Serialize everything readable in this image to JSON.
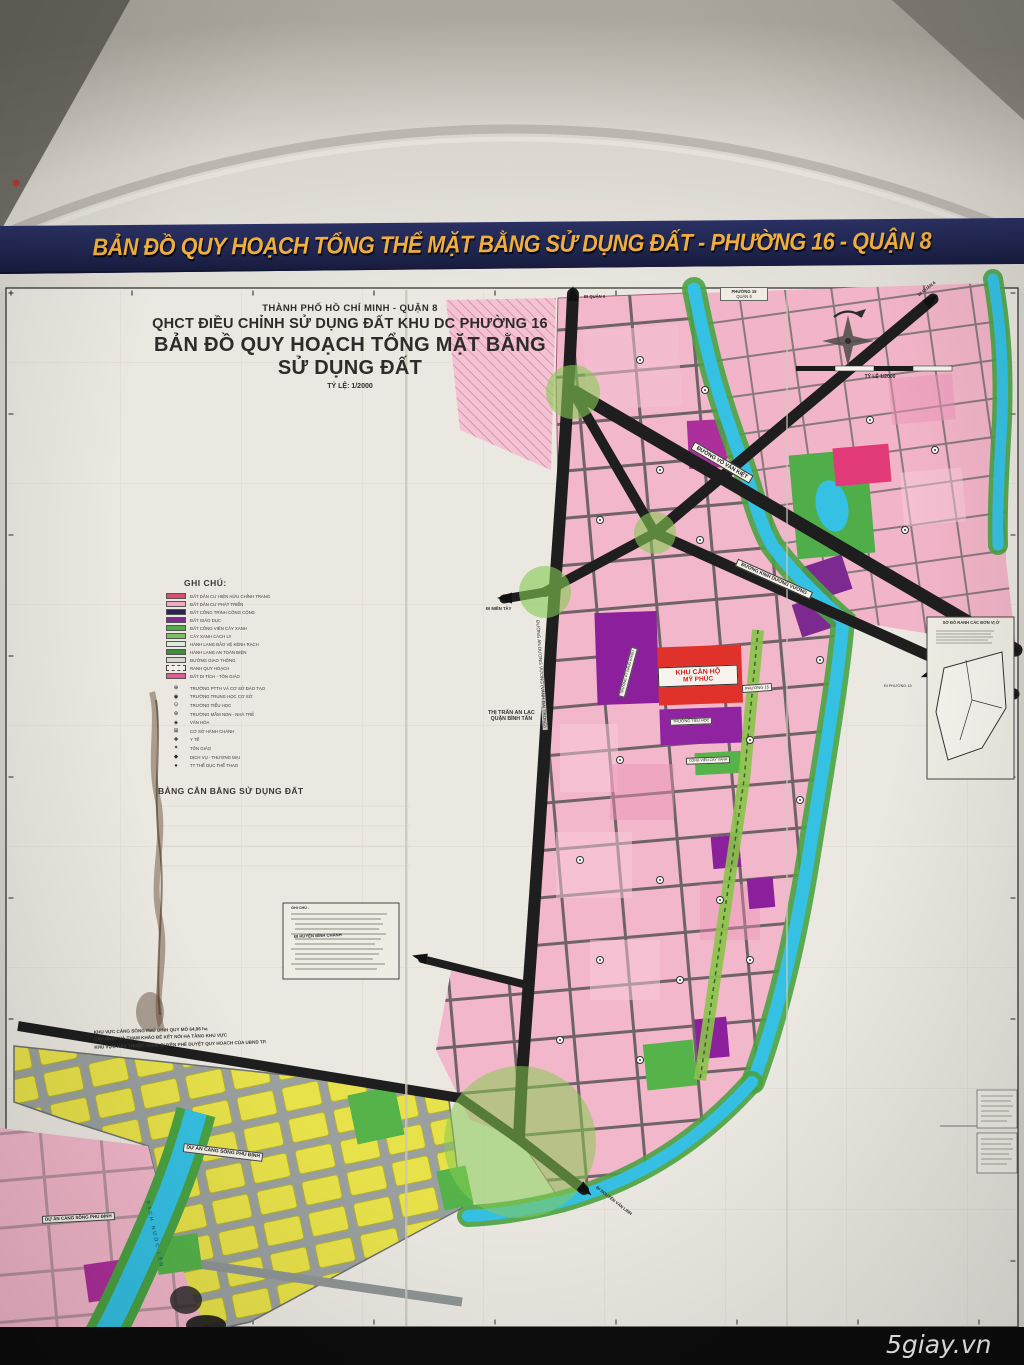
{
  "banner": {
    "title": "BẢN ĐỒ QUY HOẠCH TỔNG THỂ MẶT BẰNG SỬ DỤNG ĐẤT - PHƯỜNG 16 - QUẬN 8"
  },
  "header": {
    "line1": "THÀNH PHỐ HỒ CHÍ MINH - QUẬN 8",
    "line2": "QHCT ĐIỀU CHỈNH SỬ DỤNG ĐẤT KHU DC PHƯỜNG 16",
    "line3": "BẢN ĐỒ QUY HOẠCH TỔNG MẶT BẰNG SỬ DỤNG ĐẤT",
    "line4": "TỶ LỆ: 1/2000"
  },
  "compass": {
    "scale_caption": "TỶ LỆ 1/2000"
  },
  "legend": {
    "title": "GHI CHÚ:",
    "items": [
      {
        "label": "ĐẤT DÂN CƯ HIỆN HỮU CHỈNH TRANG",
        "color": "#d94f72"
      },
      {
        "label": "ĐẤT DÂN CƯ PHÁT TRIỂN",
        "color": "#f2a8c0"
      },
      {
        "label": "ĐẤT CÔNG TRÌNH CÔNG CỘNG",
        "color": "#2a2550"
      },
      {
        "label": "ĐẤT GIÁO DỤC",
        "color": "#7b2a8f"
      },
      {
        "label": "ĐẤT CÔNG VIÊN CÂY XANH",
        "color": "#4fae4a"
      },
      {
        "label": "CÂY XANH CÁCH LY",
        "color": "#7dbf63"
      },
      {
        "label": "HÀNH LANG BẢO VỆ KÊNH RẠCH",
        "color": "#dcead8"
      },
      {
        "label": "HÀNH LANG AN TOÀN ĐIỆN",
        "color": "#3f8f3f"
      },
      {
        "label": "ĐƯỜNG GIAO THÔNG",
        "color": "#d9d6cf"
      },
      {
        "label": "RANH QUY HOẠCH",
        "color": "#f1eee6"
      },
      {
        "label": "ĐẤT DI TÍCH - TÔN GIÁO",
        "color": "#e05a94"
      }
    ],
    "symbols": [
      {
        "glyph": "⊕",
        "label": "TRƯỜNG PTTH VÀ CƠ SỞ ĐÀO TẠO"
      },
      {
        "glyph": "◉",
        "label": "TRƯỜNG TRUNG HỌC CƠ SỞ"
      },
      {
        "glyph": "⊙",
        "label": "TRƯỜNG TIỂU HỌC"
      },
      {
        "glyph": "⊛",
        "label": "TRƯỜNG MẦM NON - NHÀ TRẺ"
      },
      {
        "glyph": "◈",
        "label": "VĂN HÓA"
      },
      {
        "glyph": "⊞",
        "label": "CƠ SỞ HÀNH CHÁNH"
      },
      {
        "glyph": "✚",
        "label": "Y TẾ"
      },
      {
        "glyph": "✦",
        "label": "TÔN GIÁO"
      },
      {
        "glyph": "◆",
        "label": "DỊCH VỤ - THƯƠNG MẠI"
      },
      {
        "glyph": "●",
        "label": "TT THỂ DỤC THỂ THAO"
      }
    ]
  },
  "balance": {
    "title": "BẢNG CÂN BẰNG SỬ DỤNG ĐẤT"
  },
  "note_box": {
    "title": "GHI CHÚ :"
  },
  "minimap": {
    "title": "SƠ ĐỒ RANH CÁC ĐƠN VỊ Ở",
    "exit_label": "ĐI PHƯỜNG 15"
  },
  "map_labels": {
    "phuong15": "PHƯỜNG 15",
    "quan6": "QUẬN 6",
    "thi_tran_1": "THỊ TRẤN AN LẠC",
    "thi_tran_2": "QUẬN BÌNH TÂN",
    "road_v": "ĐƯỜNG AN DƯƠNG VƯƠNG (VÀNH ĐAI TRONG)",
    "road_a": "ĐƯỜNG VÕ VĂN KIỆT",
    "road_b": "ĐƯỜNG KINH DƯƠNG VƯƠNG",
    "di_mien_tay": "ĐI MIỀN TÂY",
    "di_quan6": "ĐI QUẬN 6",
    "di_quan6_2": "ĐI QUẬN 6",
    "di_binh_chanh": "ĐI HUYỆN BÌNH CHÁNH",
    "di_nvl": "ĐI NGUYỄN VĂN LINH",
    "khu_can_ho_1": "KHU CĂN HỘ",
    "khu_can_ho_2": "MỸ PHÚC",
    "phuong15_chip": "PHƯỜNG 15",
    "school_chip_1": "TRƯỜNG PT NĂNG KHIẾU",
    "school_chip_2": "TRƯỜNG TIỂU HỌC",
    "green_chip": "CÔNG VIÊN CÂY XANH",
    "du_an_1": "DỰ ÁN CẢNG SÔNG PHÚ ĐỊNH",
    "du_an_2": "DỰ ÁN CẢNG SÔNG PHÚ ĐỊNH",
    "rach": "RẠCH NƯỚC LÊN",
    "warning_1": "KHU VỰC CẢNG SÔNG PHÚ ĐỊNH QUY MÔ 64,96 ha",
    "warning_2": "CẬP NHẬT VÀ THAM KHẢO ĐỂ KẾT NỐI HẠ TẦNG KHU VỰC",
    "warning_3": "KHU VỰC NÀY THUỘC THẨM QUYỀN PHÊ DUYỆT QUY HOẠCH CỦA UBND TP."
  },
  "watermark": "5giay.vn",
  "colors": {
    "wall": "#d8d4cd",
    "banner": "#20264f",
    "gold": "#f0ae3c",
    "sheet": "#ebe8e1",
    "pink": "#f2b7ca",
    "pinkDark": "#ee9cbc",
    "crimson": "#e23a78",
    "red": "#e0312a",
    "purple": "#8b1f9c",
    "magenta": "#ad2f9b",
    "green": "#55b34a",
    "lightGreen": "#8bc34a",
    "circleGreen": "#86ca52",
    "cyan": "#35c1e4",
    "yellow": "#e8e24a",
    "road": "#1e1e1e",
    "grayRoad": "#9aa0a0"
  }
}
